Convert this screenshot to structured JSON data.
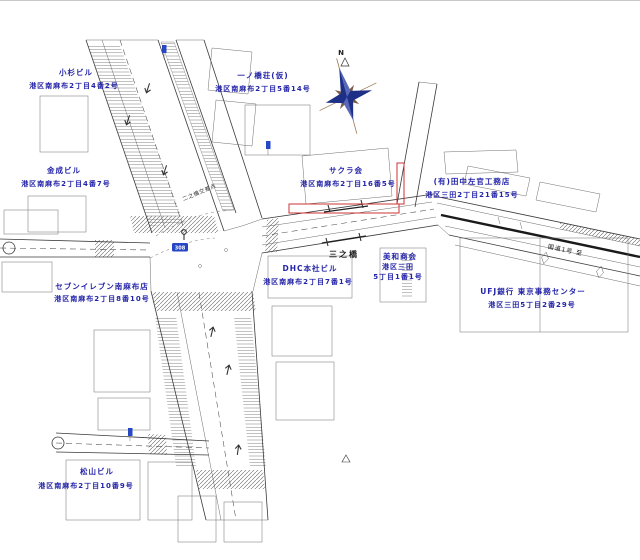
{
  "buildings": [
    {
      "name": "小杉ビル",
      "address": "港区南麻布2丁目4番2号"
    },
    {
      "name": "金成ビル",
      "address": "港区南麻布2丁目4番7号"
    },
    {
      "name": "一ノ橋荘(仮)",
      "address": "港区南麻布2丁目5番14号"
    },
    {
      "name": "サクラ会",
      "address": "港区南麻布2丁目16番5号"
    },
    {
      "name": "(有)田中左官工務店",
      "address": "港区三田2丁目21番15号"
    },
    {
      "name": "DHC本社ビル",
      "address": "港区南麻布2丁目7番1号"
    },
    {
      "name": "美和商会",
      "address": "港区三田",
      "address2": "5丁目1番1号"
    },
    {
      "name": "UFJ銀行 東京事務センター",
      "address": "港区三田5丁目2番29号"
    },
    {
      "name": "セブンイレブン南麻布店",
      "address": "港区南麻布2丁目8番10号"
    },
    {
      "name": "松山ビル",
      "address": "港区南麻布2丁目10番9号"
    }
  ],
  "map_texts": {
    "bridge": "三之橋",
    "crossing": "二之橋交差点",
    "route": "国道1号 至",
    "compass_north": "N",
    "route_shield": "308"
  },
  "colors": {
    "label_blue": "#2424a8",
    "highlight_red": "#cc3333",
    "compass_navy": "#1d2f86",
    "compass_brown": "#7a5c46",
    "sign_blue": "#2747c4",
    "line_gray": "#3a3a3a"
  }
}
